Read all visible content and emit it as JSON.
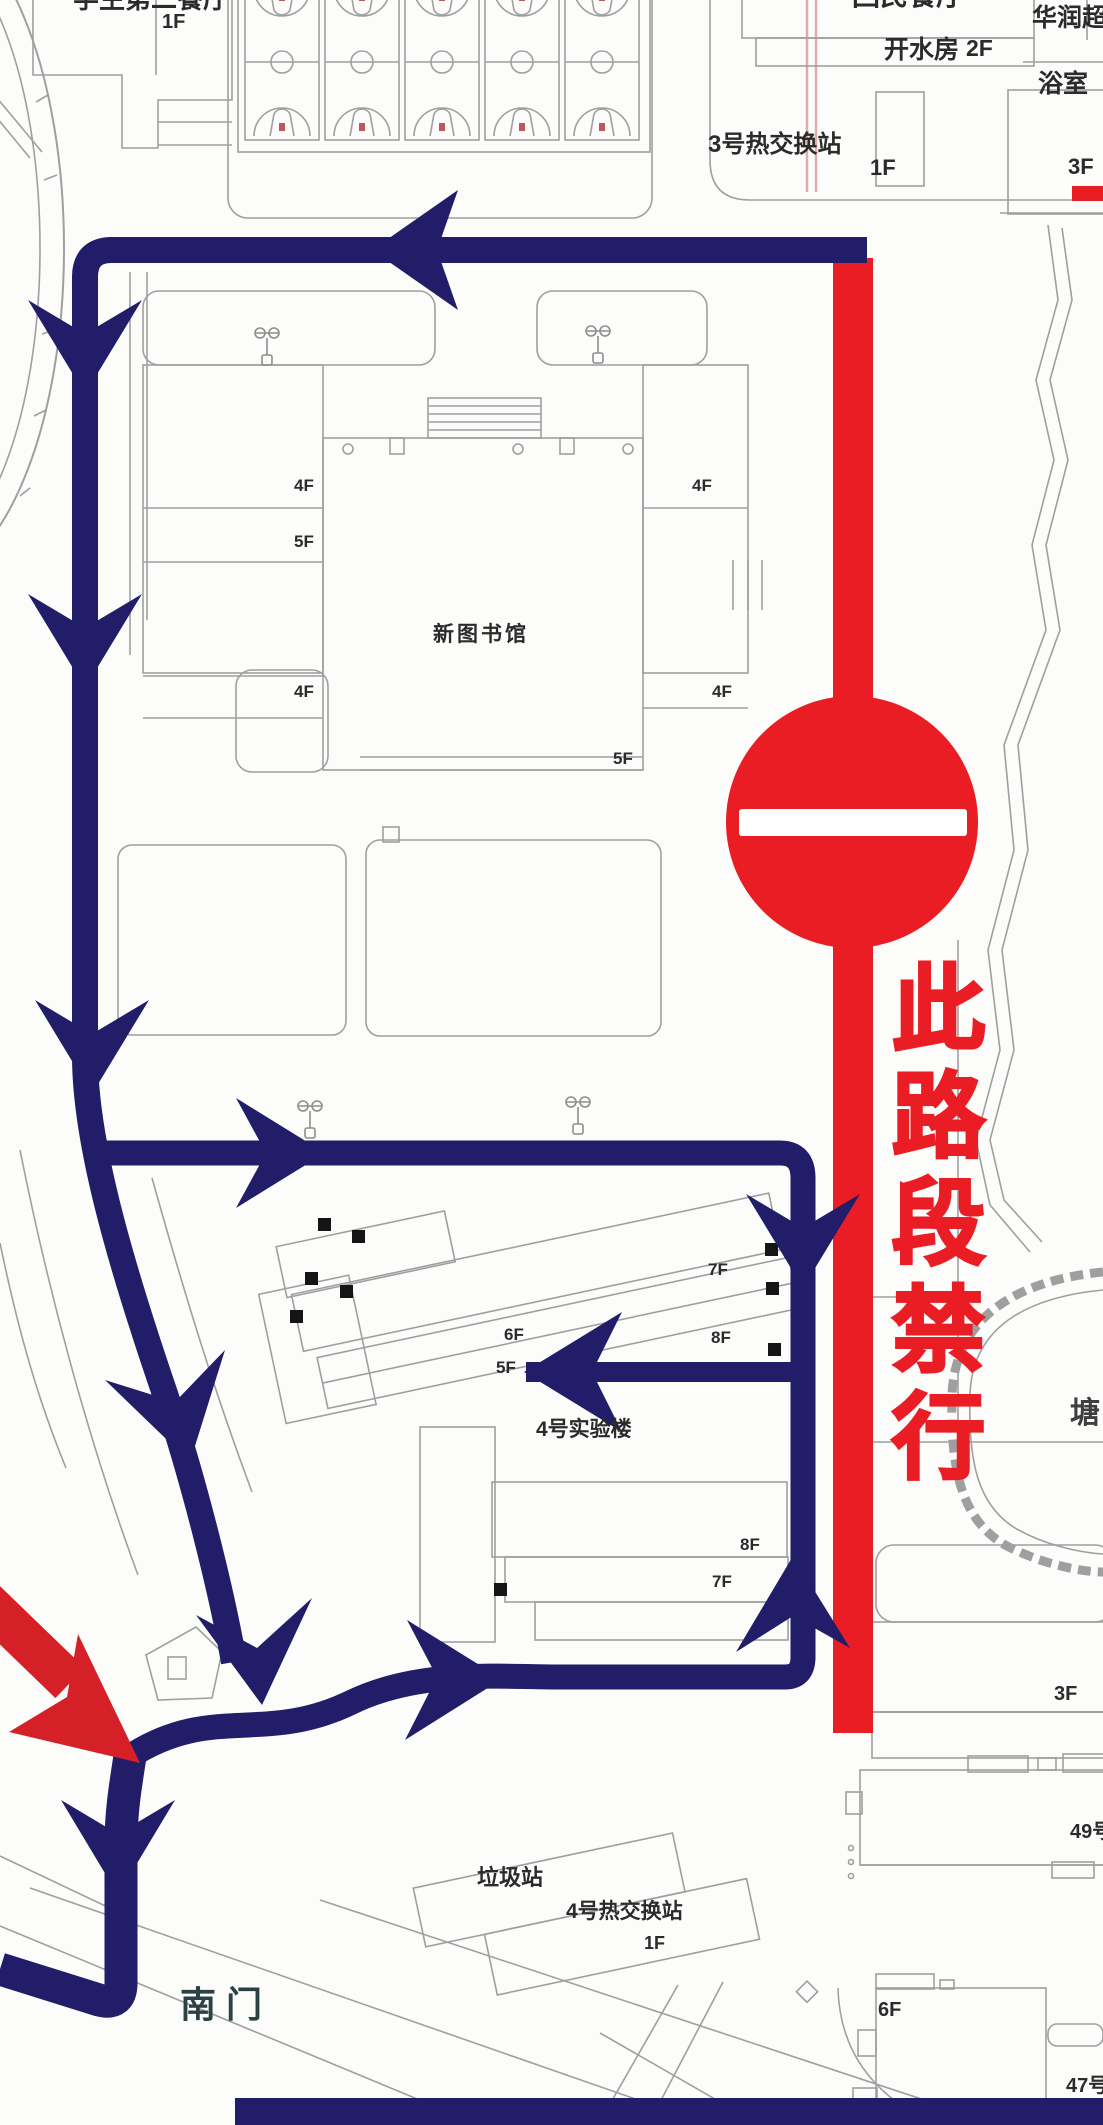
{
  "colors": {
    "route_navy": "#211d69",
    "closure_red": "#ea1c24",
    "entry_arrow_red": "#d62027",
    "line_gray": "#9f9f9f",
    "label_dark": "#2b2b2b",
    "south_gate_label": "#2c4146"
  },
  "closure": {
    "vertical_text": "此路段禁行",
    "sign": "no-entry"
  },
  "labels": [
    {
      "name": "label-student-canteen-2",
      "text": "学生第二餐厅",
      "x": 73,
      "y": -14,
      "size": 26
    },
    {
      "name": "label-student-canteen-2-floor",
      "text": "1F",
      "x": 162,
      "y": 12,
      "size": 20
    },
    {
      "name": "label-hui-canteen",
      "text": "回民餐厅",
      "x": 852,
      "y": -19,
      "size": 28
    },
    {
      "name": "label-huarun-supermarket",
      "text": "华润超市",
      "x": 1032,
      "y": 5,
      "size": 25
    },
    {
      "name": "label-hot-water-room",
      "text": "开水房",
      "x": 884,
      "y": 37,
      "size": 25
    },
    {
      "name": "label-hot-water-room-floor",
      "text": "2F",
      "x": 966,
      "y": 36,
      "size": 23
    },
    {
      "name": "label-bathhouse",
      "text": "浴室",
      "x": 1038,
      "y": 71,
      "size": 25
    },
    {
      "name": "label-heat-exchange-3",
      "text": "3号热交换站",
      "x": 708,
      "y": 132,
      "size": 24
    },
    {
      "name": "label-heat-exchange-3-floor",
      "text": "1F",
      "x": 870,
      "y": 156,
      "size": 22
    },
    {
      "name": "label-3f-top-right",
      "text": "3F",
      "x": 1068,
      "y": 155,
      "size": 22
    },
    {
      "name": "label-library-4f-left-upper",
      "text": "4F",
      "x": 294,
      "y": 477,
      "size": 17
    },
    {
      "name": "label-library-5f-left",
      "text": "5F",
      "x": 294,
      "y": 533,
      "size": 17
    },
    {
      "name": "label-library-4f-right-upper",
      "text": "4F",
      "x": 692,
      "y": 477,
      "size": 17
    },
    {
      "name": "label-library-4f-left-lower",
      "text": "4F",
      "x": 294,
      "y": 683,
      "size": 17
    },
    {
      "name": "label-library-4f-right-lower",
      "text": "4F",
      "x": 712,
      "y": 683,
      "size": 17
    },
    {
      "name": "label-new-library",
      "text": "新图书馆",
      "x": 433,
      "y": 624,
      "size": 21,
      "ls": 3
    },
    {
      "name": "label-library-5f-bottom",
      "text": "5F",
      "x": 613,
      "y": 750,
      "size": 17
    },
    {
      "name": "label-lab4-7f-upper",
      "text": "7F",
      "x": 708,
      "y": 1261,
      "size": 17
    },
    {
      "name": "label-lab4-8f-upper",
      "text": "8F",
      "x": 711,
      "y": 1329,
      "size": 17
    },
    {
      "name": "label-lab4-6f",
      "text": "6F",
      "x": 504,
      "y": 1326,
      "size": 17
    },
    {
      "name": "label-lab4-5f",
      "text": "5F",
      "x": 496,
      "y": 1359,
      "size": 17
    },
    {
      "name": "label-lab4",
      "text": "4号实验楼",
      "x": 536,
      "y": 1419,
      "size": 21
    },
    {
      "name": "label-lab4-8f-lower",
      "text": "8F",
      "x": 740,
      "y": 1536,
      "size": 17
    },
    {
      "name": "label-lab4-7f-lower",
      "text": "7F",
      "x": 712,
      "y": 1573,
      "size": 17
    },
    {
      "name": "label-garbage-station",
      "text": "垃圾站",
      "x": 477,
      "y": 1866,
      "size": 22
    },
    {
      "name": "label-heat-exchange-4",
      "text": "4号热交换站",
      "x": 566,
      "y": 1901,
      "size": 21
    },
    {
      "name": "label-heat-exchange-4-floor",
      "text": "1F",
      "x": 644,
      "y": 1934,
      "size": 18
    },
    {
      "name": "label-south-gate",
      "text": "南门",
      "x": 180,
      "y": 1986,
      "size": 36,
      "color": "#2c4146",
      "ls": 10
    },
    {
      "name": "label-3f-bottom-right",
      "text": "3F",
      "x": 1054,
      "y": 1684,
      "size": 20
    },
    {
      "name": "label-building-49",
      "text": "49号",
      "x": 1070,
      "y": 1822,
      "size": 20
    },
    {
      "name": "label-6f-bottom-right",
      "text": "6F",
      "x": 878,
      "y": 2000,
      "size": 20
    },
    {
      "name": "label-building-47",
      "text": "47号",
      "x": 1066,
      "y": 2076,
      "size": 20
    },
    {
      "name": "label-pond",
      "text": "塘",
      "x": 1070,
      "y": 1398,
      "size": 30,
      "color": "#3f3f3f"
    }
  ]
}
